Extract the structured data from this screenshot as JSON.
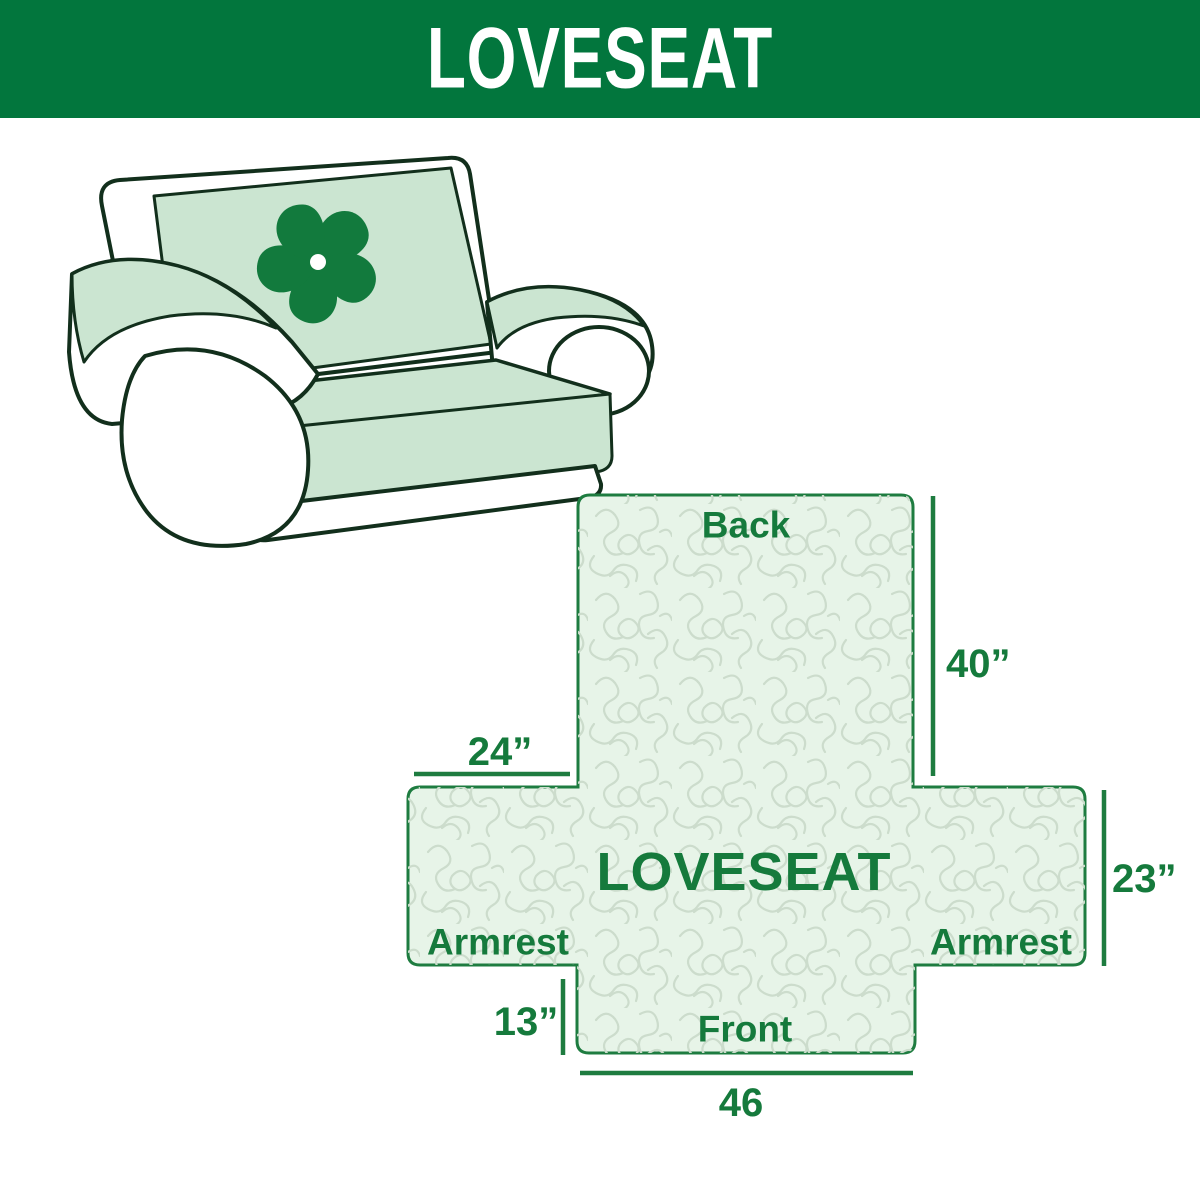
{
  "banner": {
    "title": "LOVESEAT"
  },
  "illustration": {
    "subject": "loveseat sofa with quilted furniture cover",
    "logo_icon": "pinwheel-fan",
    "cover_color": "#cbe5d1",
    "outline_color": "#122f1c",
    "logo_color": "#127a3d"
  },
  "diagram": {
    "center_label": "LOVESEAT",
    "back_label": "Back",
    "front_label": "Front",
    "armrest_left_label": "Armrest",
    "armrest_right_label": "Armrest",
    "dim_back_height": "40”",
    "dim_armrest_width": "24”",
    "dim_armrest_height": "23”",
    "dim_front_drop": "13”",
    "dim_front_width": "46",
    "colors": {
      "banner_green": "#02763d",
      "label_green": "#157a3c",
      "diagram_border": "#1e7c40",
      "diagram_fill": "#e7f4e8",
      "quilt_line": "#ccdccc"
    }
  }
}
